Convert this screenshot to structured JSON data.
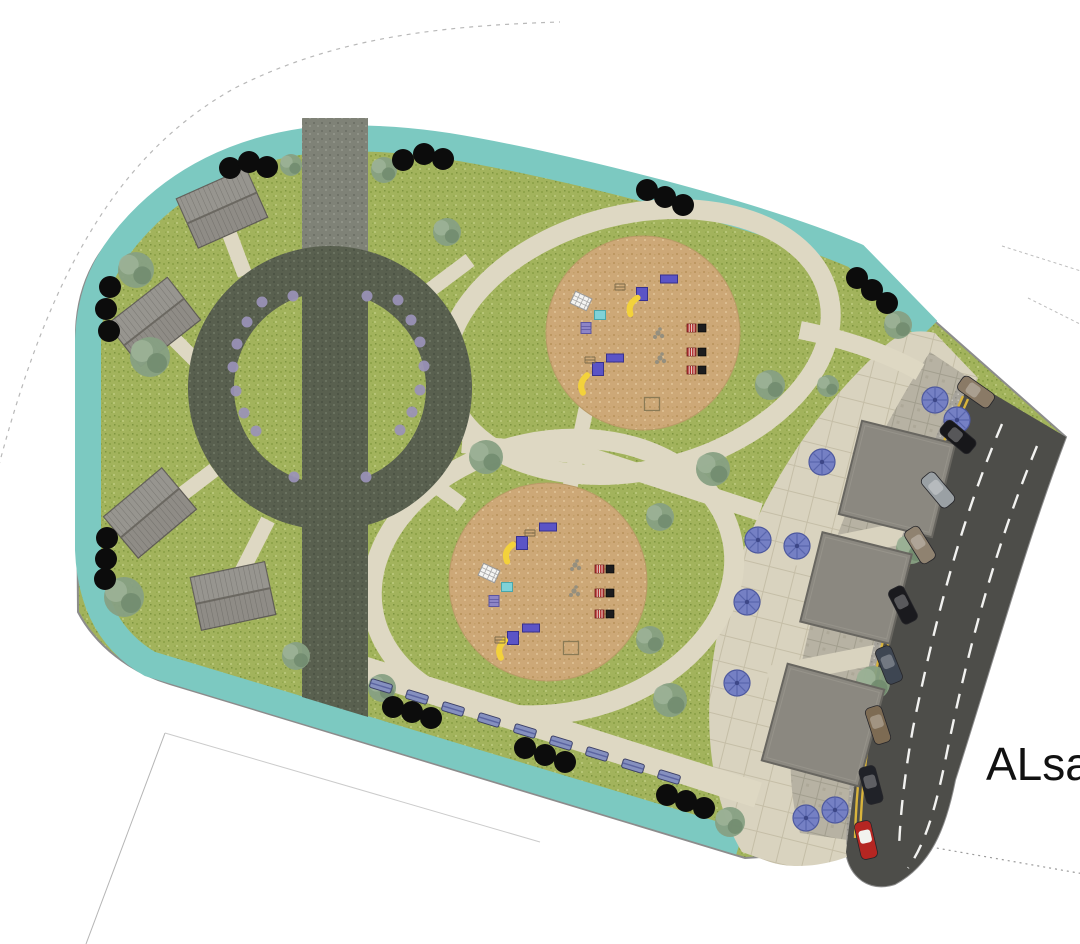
{
  "street_label": "ALsah",
  "palette": {
    "lawn": "#a2b35c",
    "teal": "#7cc9c1",
    "outline": "#8c8c8c",
    "boundary": "#ababab",
    "sand": "#cda877",
    "path": "#ded8c3",
    "plaza": "#d9d3bf",
    "stone": "#b7b2a3",
    "parking": "#a6a39b",
    "road": "#4d4d49",
    "road_yellow": "#d9b43c",
    "road_white": "#f2f2f0",
    "band": "#59604f",
    "band_top": "#7f8277",
    "roof": "#8f8c86",
    "kiosk": "#8b8880",
    "tree_black": "#0c0c0c",
    "shrub": "#87a083",
    "shrub_light": "#9db398",
    "shrub_dark": "#6f8a6d",
    "bench": "#8590bf",
    "umbrella": "#7580c4",
    "purple_dot": "#9a93b8",
    "play_blue": "#5b54c6",
    "play_yellow": "#f3d23b",
    "play_cyan": "#7fd2d8",
    "play_purple": "#8d85c6",
    "bench_red": "#b53030",
    "label": "#111111"
  },
  "features": {
    "ring": {
      "cx": 330,
      "cy": 388,
      "outer_r": 142,
      "inner_r": 96
    },
    "promenade_band": {
      "x1": 302,
      "x2": 368,
      "top": 118,
      "split": 252
    },
    "playgrounds": [
      {
        "cx": 643,
        "cy": 333,
        "r": 97
      },
      {
        "cx": 548,
        "cy": 582,
        "r": 99
      }
    ],
    "pavilions": [
      {
        "x": 222,
        "y": 208,
        "rot": -24
      },
      {
        "x": 154,
        "y": 322,
        "rot": -38
      },
      {
        "x": 150,
        "y": 513,
        "rot": -40
      },
      {
        "x": 233,
        "y": 596,
        "rot": -12
      }
    ],
    "kiosk_squares": [
      {
        "x": 897,
        "y": 479,
        "s": 96,
        "rot": 14
      },
      {
        "x": 856,
        "y": 588,
        "s": 92,
        "rot": 14
      },
      {
        "x": 823,
        "y": 725,
        "s": 100,
        "rot": 15
      }
    ],
    "umbrellas": [
      [
        935,
        400
      ],
      [
        957,
        420
      ],
      [
        822,
        462
      ],
      [
        758,
        540
      ],
      [
        797,
        546
      ],
      [
        747,
        602
      ],
      [
        737,
        683
      ],
      [
        806,
        818
      ],
      [
        835,
        810
      ]
    ],
    "cars": [
      {
        "x": 976,
        "y": 392,
        "rot": -55,
        "color": "#8a7a66"
      },
      {
        "x": 958,
        "y": 437,
        "rot": -50,
        "color": "#17171a"
      },
      {
        "x": 938,
        "y": 490,
        "rot": -40,
        "color": "#9aa0a4"
      },
      {
        "x": 920,
        "y": 545,
        "rot": -32,
        "color": "#8f8270"
      },
      {
        "x": 903,
        "y": 605,
        "rot": -27,
        "color": "#1a1a1e"
      },
      {
        "x": 889,
        "y": 665,
        "rot": -22,
        "color": "#3e4652"
      },
      {
        "x": 878,
        "y": 725,
        "rot": -18,
        "color": "#7d6b53"
      },
      {
        "x": 871,
        "y": 785,
        "rot": -15,
        "color": "#202228"
      },
      {
        "x": 866,
        "y": 840,
        "rot": -13,
        "color": "#b52622",
        "white_roof": true
      }
    ],
    "benches": [
      [
        381,
        686
      ],
      [
        417,
        697
      ],
      [
        453,
        709
      ],
      [
        489,
        720
      ],
      [
        525,
        731
      ],
      [
        561,
        743
      ],
      [
        597,
        754
      ],
      [
        633,
        766
      ],
      [
        669,
        777
      ]
    ],
    "black_trees": [
      [
        230,
        168
      ],
      [
        249,
        162
      ],
      [
        267,
        167
      ],
      [
        403,
        160
      ],
      [
        424,
        154
      ],
      [
        443,
        159
      ],
      [
        647,
        190
      ],
      [
        665,
        197
      ],
      [
        683,
        205
      ],
      [
        857,
        278
      ],
      [
        872,
        290
      ],
      [
        887,
        303
      ],
      [
        110,
        287
      ],
      [
        106,
        309
      ],
      [
        109,
        331
      ],
      [
        107,
        538
      ],
      [
        106,
        559
      ],
      [
        105,
        579
      ],
      [
        393,
        707
      ],
      [
        412,
        712
      ],
      [
        431,
        718
      ],
      [
        525,
        748
      ],
      [
        545,
        755
      ],
      [
        565,
        762
      ],
      [
        667,
        795
      ],
      [
        686,
        801
      ],
      [
        704,
        808
      ]
    ],
    "shrubs": [
      [
        136,
        270,
        18
      ],
      [
        150,
        357,
        20
      ],
      [
        124,
        597,
        20
      ],
      [
        291,
        165,
        11
      ],
      [
        384,
        170,
        13
      ],
      [
        447,
        232,
        14
      ],
      [
        486,
        457,
        17
      ],
      [
        713,
        469,
        17
      ],
      [
        770,
        385,
        15
      ],
      [
        660,
        517,
        14
      ],
      [
        650,
        640,
        14
      ],
      [
        828,
        386,
        11
      ],
      [
        911,
        549,
        15
      ],
      [
        873,
        683,
        17
      ],
      [
        730,
        822,
        15
      ],
      [
        670,
        700,
        17
      ],
      [
        296,
        656,
        14
      ],
      [
        382,
        688,
        14
      ],
      [
        898,
        325,
        14
      ]
    ],
    "ring_dots": [
      [
        262,
        302
      ],
      [
        247,
        322
      ],
      [
        237,
        344
      ],
      [
        233,
        367
      ],
      [
        236,
        391
      ],
      [
        244,
        413
      ],
      [
        256,
        431
      ],
      [
        398,
        300
      ],
      [
        411,
        320
      ],
      [
        420,
        342
      ],
      [
        424,
        366
      ],
      [
        420,
        390
      ],
      [
        412,
        412
      ],
      [
        400,
        430
      ],
      [
        293,
        296
      ],
      [
        367,
        296
      ],
      [
        294,
        477
      ],
      [
        366,
        477
      ]
    ],
    "play_items": [
      {
        "t": "lattice",
        "x": 581,
        "y": 301,
        "r": 25
      },
      {
        "t": "cyan",
        "x": 600,
        "y": 315
      },
      {
        "t": "purple",
        "x": 586,
        "y": 328
      },
      {
        "t": "brect",
        "x": 669,
        "y": 279
      },
      {
        "t": "bsq",
        "x": 642,
        "y": 294
      },
      {
        "t": "slide",
        "x": 634,
        "y": 306,
        "r": -130
      },
      {
        "t": "climb",
        "x": 620,
        "y": 287
      },
      {
        "t": "brect",
        "x": 615,
        "y": 358
      },
      {
        "t": "bsq",
        "x": 598,
        "y": 369
      },
      {
        "t": "slide",
        "x": 585,
        "y": 384,
        "r": -140
      },
      {
        "t": "climb",
        "x": 590,
        "y": 360
      },
      {
        "t": "bench",
        "x": 696,
        "y": 328
      },
      {
        "t": "bench",
        "x": 696,
        "y": 352
      },
      {
        "t": "bench",
        "x": 696,
        "y": 370
      },
      {
        "t": "rocks",
        "x": 658,
        "y": 333
      },
      {
        "t": "rocks",
        "x": 660,
        "y": 358
      },
      {
        "t": "osq",
        "x": 652,
        "y": 404
      },
      {
        "t": "brect",
        "x": 548,
        "y": 527
      },
      {
        "t": "bsq",
        "x": 522,
        "y": 543
      },
      {
        "t": "slide",
        "x": 510,
        "y": 553,
        "r": -135
      },
      {
        "t": "climb",
        "x": 530,
        "y": 533
      },
      {
        "t": "lattice",
        "x": 489,
        "y": 573,
        "r": 25
      },
      {
        "t": "cyan",
        "x": 507,
        "y": 587
      },
      {
        "t": "purple",
        "x": 494,
        "y": 601
      },
      {
        "t": "brect",
        "x": 531,
        "y": 628
      },
      {
        "t": "bsq",
        "x": 513,
        "y": 638
      },
      {
        "t": "slide",
        "x": 503,
        "y": 649,
        "r": -140
      },
      {
        "t": "climb",
        "x": 500,
        "y": 640
      },
      {
        "t": "bench",
        "x": 604,
        "y": 569
      },
      {
        "t": "bench",
        "x": 604,
        "y": 593
      },
      {
        "t": "bench",
        "x": 604,
        "y": 614
      },
      {
        "t": "rocks",
        "x": 575,
        "y": 565
      },
      {
        "t": "rocks",
        "x": 574,
        "y": 591
      },
      {
        "t": "osq",
        "x": 571,
        "y": 648
      }
    ]
  }
}
